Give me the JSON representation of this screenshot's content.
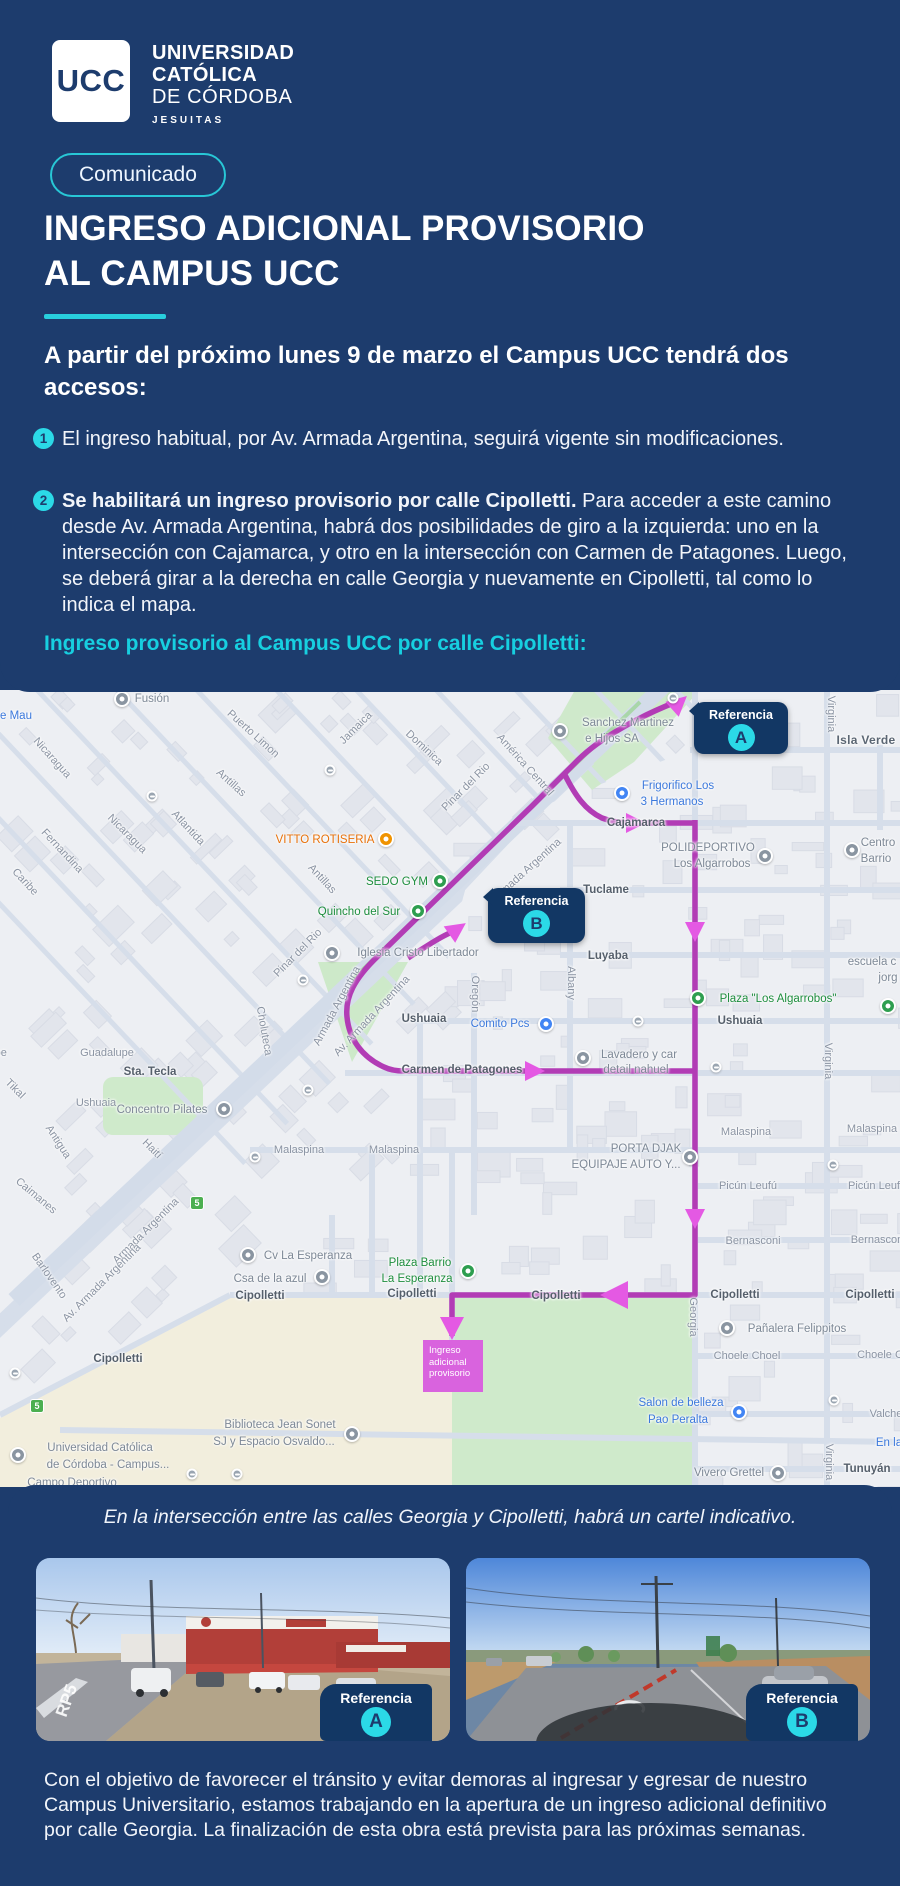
{
  "colors": {
    "navy": "#1d3c6d",
    "navy_dark": "#123764",
    "accent_cyan": "#2bd9e7",
    "heading_cyan": "#17cfe0",
    "route_purple": "#b23cb5",
    "route_arrow": "#e459e3",
    "ingreso_pink": "#d963de"
  },
  "header": {
    "logo_acronym": "UCC",
    "logo_lines": {
      "l1": "UNIVERSIDAD",
      "l2": "CATÓLICA",
      "l3": "DE CÓRDOBA",
      "l4": "JESUITAS"
    },
    "badge": "Comunicado",
    "title_line1": "INGRESO ADICIONAL PROVISORIO",
    "title_line2": "AL CAMPUS UCC"
  },
  "intro": "A partir del próximo lunes 9 de marzo el Campus UCC tendrá dos accesos:",
  "items": [
    {
      "num": "1",
      "text": "El ingreso habitual, por Av. Armada Argentina, seguirá vigente sin modificaciones."
    },
    {
      "num": "2",
      "bold": "Se habilitará un ingreso provisorio por calle Cipolletti.",
      "text": " Para acceder a este camino desde Av. Armada Argentina, habrá dos posibilidades de giro a la izquierda: uno en la intersección con Cajamarca, y otro en la intersección con Carmen de Patagones. Luego, se deberá girar a la derecha en calle Georgia y nuevamente en Cipolletti, tal como lo indica el mapa."
    }
  ],
  "map_heading": "Ingreso provisorio al Campus UCC por calle Cipolletti:",
  "map": {
    "callout_a": {
      "label": "Referencia",
      "letter": "A"
    },
    "callout_b": {
      "label": "Referencia",
      "letter": "B"
    },
    "ingreso_box": {
      "lines": [
        "Ingreso",
        "adicional",
        "provisorio"
      ]
    },
    "labels": [
      {
        "t": "e Mau",
        "x": 16,
        "y": 26,
        "c": "b"
      },
      {
        "t": "Fusión",
        "x": 152,
        "y": 9,
        "c": "gr"
      },
      {
        "t": "Puerto Limon",
        "x": 253,
        "y": 44,
        "r": 42,
        "c": "st"
      },
      {
        "t": "Jamaica",
        "x": 356,
        "y": 38,
        "r": -45,
        "c": "st"
      },
      {
        "t": "Dominica",
        "x": 424,
        "y": 58,
        "r": 43,
        "c": "st"
      },
      {
        "t": "Nicaragua",
        "x": 52,
        "y": 68,
        "r": 48,
        "c": "st"
      },
      {
        "t": "Antillas",
        "x": 231,
        "y": 93,
        "r": 42,
        "c": "st"
      },
      {
        "t": "Atlantida",
        "x": 188,
        "y": 138,
        "r": 47,
        "c": "st"
      },
      {
        "t": "Nicaragua",
        "x": 127,
        "y": 144,
        "r": 45,
        "c": "st"
      },
      {
        "t": "Fernandina",
        "x": 62,
        "y": 161,
        "r": 47,
        "c": "st"
      },
      {
        "t": "Caribe",
        "x": 25,
        "y": 192,
        "r": 47,
        "c": "st"
      },
      {
        "t": "Pinar del Rio",
        "x": 466,
        "y": 97,
        "r": -45,
        "c": "st"
      },
      {
        "t": "América Central",
        "x": 525,
        "y": 75,
        "r": 48,
        "c": "st"
      },
      {
        "t": "VITTO ROTISERIA",
        "x": 325,
        "y": 150,
        "c": "o"
      },
      {
        "t": "SEDO GYM",
        "x": 397,
        "y": 192,
        "c": "g"
      },
      {
        "t": "Quincho del Sur",
        "x": 359,
        "y": 222,
        "c": "g"
      },
      {
        "t": "Antillas",
        "x": 322,
        "y": 189,
        "r": 47,
        "c": "st"
      },
      {
        "t": "Sanchez Martinez",
        "x": 628,
        "y": 33,
        "c": "gr"
      },
      {
        "t": "e Hijos SA",
        "x": 612,
        "y": 49,
        "c": "gr"
      },
      {
        "t": "Frigorifico Los",
        "x": 678,
        "y": 96,
        "c": "b"
      },
      {
        "t": "3 Hermanos",
        "x": 672,
        "y": 112,
        "c": "b"
      },
      {
        "t": "Cajamarca",
        "x": 636,
        "y": 133,
        "c": "stb"
      },
      {
        "t": "Isla Verde",
        "x": 866,
        "y": 50,
        "c": "loc"
      },
      {
        "t": "Virginia",
        "x": 831,
        "y": 24,
        "r": 90,
        "c": "st"
      },
      {
        "t": "POLIDEPORTIVO",
        "x": 708,
        "y": 158,
        "c": "gr"
      },
      {
        "t": "Los Algarrobos",
        "x": 712,
        "y": 174,
        "c": "gr"
      },
      {
        "t": "Centro",
        "x": 878,
        "y": 153,
        "c": "gr"
      },
      {
        "t": "Barrio",
        "x": 876,
        "y": 169,
        "c": "gr"
      },
      {
        "t": "Tuclame",
        "x": 606,
        "y": 200,
        "c": "stb"
      },
      {
        "t": "Luyaba",
        "x": 608,
        "y": 266,
        "c": "stb"
      },
      {
        "t": "Albany",
        "x": 571,
        "y": 293,
        "r": 90,
        "c": "st"
      },
      {
        "t": "Oregón",
        "x": 475,
        "y": 304,
        "r": 90,
        "c": "st"
      },
      {
        "t": "Pinar del Rio",
        "x": 298,
        "y": 263,
        "r": -45,
        "c": "st"
      },
      {
        "t": "Iglesia Cristo Libertador",
        "x": 418,
        "y": 263,
        "c": "gr"
      },
      {
        "t": "escuela c",
        "x": 872,
        "y": 272,
        "c": "gr"
      },
      {
        "t": "jorg",
        "x": 888,
        "y": 288,
        "c": "gr"
      },
      {
        "t": "Plaza \"Los Algarrobos\"",
        "x": 778,
        "y": 309,
        "c": "g"
      },
      {
        "t": "Ushuaia",
        "x": 740,
        "y": 331,
        "c": "stb"
      },
      {
        "t": "Ushuaia",
        "x": 424,
        "y": 329,
        "c": "stb"
      },
      {
        "t": "Comito Pcs",
        "x": 500,
        "y": 334,
        "c": "b"
      },
      {
        "t": "Virginia",
        "x": 828,
        "y": 371,
        "r": 90,
        "c": "st"
      },
      {
        "t": "Lavadero y car",
        "x": 639,
        "y": 365,
        "c": "gr"
      },
      {
        "t": "detail nahuel",
        "x": 636,
        "y": 380,
        "c": "gr"
      },
      {
        "t": "Carmen de Patagones",
        "x": 462,
        "y": 380,
        "c": "stb"
      },
      {
        "t": "Choluteca",
        "x": 264,
        "y": 341,
        "r": 80,
        "c": "st"
      },
      {
        "t": "Armada Argentina",
        "x": 527,
        "y": 180,
        "r": -42,
        "c": "st"
      },
      {
        "t": "Armada Argentina",
        "x": 337,
        "y": 316,
        "r": -62,
        "c": "st"
      },
      {
        "t": "Av. Armada Argentina",
        "x": 372,
        "y": 326,
        "r": -47,
        "c": "st"
      },
      {
        "t": "Malaspina",
        "x": 299,
        "y": 460,
        "c": "st"
      },
      {
        "t": "Malaspina",
        "x": 394,
        "y": 460,
        "c": "st"
      },
      {
        "t": "Malaspina",
        "x": 746,
        "y": 442,
        "c": "st"
      },
      {
        "t": "Malaspina",
        "x": 872,
        "y": 439,
        "c": "st"
      },
      {
        "t": "PORTA DJAK",
        "x": 646,
        "y": 459,
        "c": "gr"
      },
      {
        "t": "EQUIPAJE AUTO Y...",
        "x": 626,
        "y": 475,
        "c": "gr"
      },
      {
        "t": "Picún Leufú",
        "x": 748,
        "y": 496,
        "c": "st"
      },
      {
        "t": "Picún Leuf",
        "x": 874,
        "y": 496,
        "c": "st"
      },
      {
        "t": "Bernasconi",
        "x": 753,
        "y": 551,
        "c": "st"
      },
      {
        "t": "Bernascon",
        "x": 877,
        "y": 550,
        "c": "st"
      },
      {
        "t": "Sta. Tecla",
        "x": 150,
        "y": 382,
        "c": "stb"
      },
      {
        "t": "Concentro Pilates",
        "x": 162,
        "y": 420,
        "c": "gr"
      },
      {
        "t": "Guadalupe",
        "x": -20,
        "y": 363,
        "c": "st"
      },
      {
        "t": "Guadalupe",
        "x": 107,
        "y": 363,
        "c": "st"
      },
      {
        "t": "Tikal",
        "x": 15,
        "y": 399,
        "r": 45,
        "c": "st"
      },
      {
        "t": "Ushuaia",
        "x": 96,
        "y": 413,
        "c": "st"
      },
      {
        "t": "Haití",
        "x": 152,
        "y": 459,
        "r": 45,
        "c": "st"
      },
      {
        "t": "Antigua",
        "x": 58,
        "y": 452,
        "r": 57,
        "c": "st"
      },
      {
        "t": "Caimanes",
        "x": 36,
        "y": 506,
        "r": 40,
        "c": "st"
      },
      {
        "t": "Barlovento",
        "x": 49,
        "y": 586,
        "r": 55,
        "c": "st"
      },
      {
        "t": "Armada Argentina",
        "x": 146,
        "y": 541,
        "r": -45,
        "c": "st"
      },
      {
        "t": "Av. Armada Argentina",
        "x": 102,
        "y": 593,
        "r": -45,
        "c": "st"
      },
      {
        "t": "Cv La Esperanza",
        "x": 308,
        "y": 566,
        "c": "gr"
      },
      {
        "t": "Csa de la azul",
        "x": 270,
        "y": 589,
        "c": "gr"
      },
      {
        "t": "Plaza Barrio",
        "x": 420,
        "y": 573,
        "c": "g"
      },
      {
        "t": "La Esperanza",
        "x": 417,
        "y": 589,
        "c": "g"
      },
      {
        "t": "Cipolletti",
        "x": 118,
        "y": 669,
        "c": "stb"
      },
      {
        "t": "Cipolletti",
        "x": 260,
        "y": 606,
        "c": "stb"
      },
      {
        "t": "Cipolletti",
        "x": 412,
        "y": 604,
        "c": "stb"
      },
      {
        "t": "Cipolletti",
        "x": 556,
        "y": 606,
        "c": "stb"
      },
      {
        "t": "Cipolletti",
        "x": 735,
        "y": 605,
        "c": "stb"
      },
      {
        "t": "Cipolletti",
        "x": 870,
        "y": 605,
        "c": "stb"
      },
      {
        "t": "Georgia",
        "x": 693,
        "y": 627,
        "r": 90,
        "c": "st"
      },
      {
        "t": "Pañalera Felippitos",
        "x": 797,
        "y": 639,
        "c": "gr"
      },
      {
        "t": "Choele Choel",
        "x": 747,
        "y": 666,
        "c": "st"
      },
      {
        "t": "Choele C",
        "x": 880,
        "y": 665,
        "c": "st"
      },
      {
        "t": "Salon de belleza",
        "x": 681,
        "y": 713,
        "c": "b"
      },
      {
        "t": "Pao Peralta",
        "x": 678,
        "y": 730,
        "c": "b"
      },
      {
        "t": "Valche",
        "x": 886,
        "y": 724,
        "c": "st"
      },
      {
        "t": "En la",
        "x": 889,
        "y": 753,
        "c": "b"
      },
      {
        "t": "Tunuyán",
        "x": 867,
        "y": 779,
        "c": "stb"
      },
      {
        "t": "Vivero Grettel",
        "x": 729,
        "y": 783,
        "c": "gr"
      },
      {
        "t": "Virginia",
        "x": 829,
        "y": 772,
        "r": 90,
        "c": "st"
      },
      {
        "t": "Biblioteca Jean Sonet",
        "x": 280,
        "y": 735,
        "c": "gr"
      },
      {
        "t": "SJ y Espacio Osvaldo...",
        "x": 274,
        "y": 752,
        "c": "gr"
      },
      {
        "t": "Universidad Católica",
        "x": 100,
        "y": 758,
        "c": "gr"
      },
      {
        "t": "de Córdoba -  Campus...",
        "x": 108,
        "y": 775,
        "c": "gr"
      },
      {
        "t": "Campo Deportivo",
        "x": 72,
        "y": 793,
        "c": "gr"
      }
    ],
    "pois": [
      {
        "x": 122,
        "y": 9,
        "k": "gray"
      },
      {
        "x": 560,
        "y": 41,
        "k": "gray"
      },
      {
        "x": 622,
        "y": 103,
        "k": "blue"
      },
      {
        "x": 386,
        "y": 149,
        "k": "orange"
      },
      {
        "x": 440,
        "y": 191,
        "k": "green"
      },
      {
        "x": 418,
        "y": 221,
        "k": "green"
      },
      {
        "x": 765,
        "y": 166,
        "k": "gray"
      },
      {
        "x": 852,
        "y": 160,
        "k": "gray"
      },
      {
        "x": 332,
        "y": 263,
        "k": "gray"
      },
      {
        "x": 888,
        "y": 316,
        "k": "green"
      },
      {
        "x": 698,
        "y": 308,
        "k": "green"
      },
      {
        "x": 546,
        "y": 334,
        "k": "blue"
      },
      {
        "x": 583,
        "y": 368,
        "k": "gray"
      },
      {
        "x": 224,
        "y": 419,
        "k": "gray"
      },
      {
        "x": 690,
        "y": 467,
        "k": "gray"
      },
      {
        "x": 248,
        "y": 565,
        "k": "gray"
      },
      {
        "x": 322,
        "y": 587,
        "k": "gray"
      },
      {
        "x": 468,
        "y": 581,
        "k": "green"
      },
      {
        "x": 727,
        "y": 638,
        "k": "gray"
      },
      {
        "x": 739,
        "y": 722,
        "k": "blue"
      },
      {
        "x": 778,
        "y": 783,
        "k": "gray"
      },
      {
        "x": 352,
        "y": 744,
        "k": "gray"
      },
      {
        "x": 18,
        "y": 765,
        "k": "gray"
      }
    ],
    "transit": [
      {
        "x": 152,
        "y": 106
      },
      {
        "x": 330,
        "y": 80
      },
      {
        "x": 673,
        "y": 8
      },
      {
        "x": 303,
        "y": 290
      },
      {
        "x": 308,
        "y": 400
      },
      {
        "x": 255,
        "y": 467
      },
      {
        "x": 638,
        "y": 331
      },
      {
        "x": 716,
        "y": 377
      },
      {
        "x": 833,
        "y": 475
      },
      {
        "x": 834,
        "y": 710
      },
      {
        "x": 15,
        "y": 683
      },
      {
        "x": 192,
        "y": 784
      },
      {
        "x": 237,
        "y": 784
      }
    ],
    "shields": [
      {
        "x": 197,
        "y": 513,
        "t": "5"
      },
      {
        "x": 37,
        "y": 716,
        "t": "5"
      }
    ]
  },
  "bottom": {
    "caption": "En la intersección entre las calles Georgia y Cipolletti, habrá un cartel indicativo.",
    "photos": [
      {
        "tag_label": "Referencia",
        "tag_letter": "A",
        "road_marking": "RP5"
      },
      {
        "tag_label": "Referencia",
        "tag_letter": "B"
      }
    ],
    "footer": "Con el objetivo de favorecer el tránsito y evitar demoras al ingresar y egresar de nuestro Campus Universitario, estamos trabajando en la apertura de un ingreso adicional definitivo por calle Georgia. La finalización de esta obra está prevista para las próximas semanas."
  }
}
